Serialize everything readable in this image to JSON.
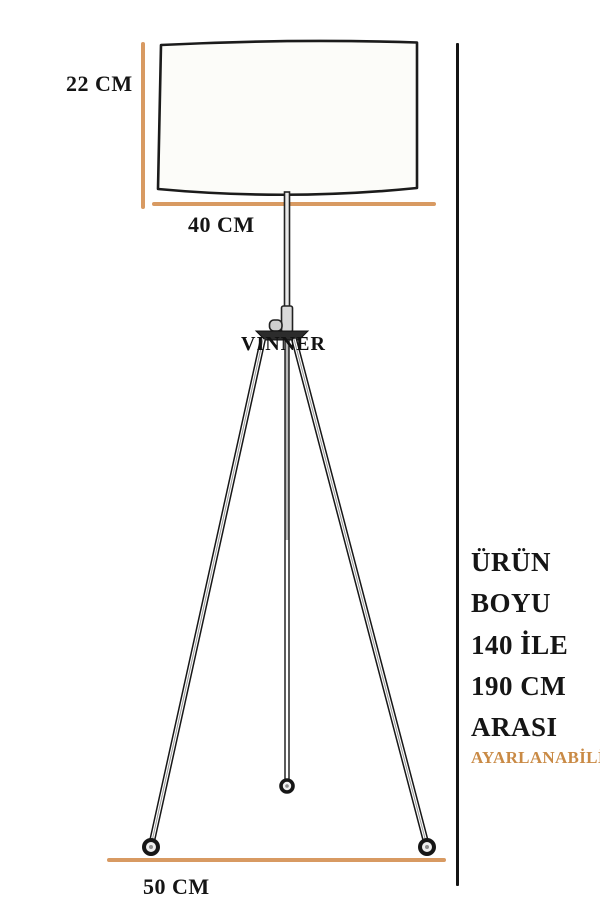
{
  "diagram": {
    "type": "product-dimension-diagram",
    "product": "tripod floor lamp",
    "labels": {
      "shade_height": "22 CM",
      "shade_width": "40 CM",
      "base_width": "50 CM"
    },
    "brand": "VINNER",
    "height_note": {
      "lines": [
        "ÜRÜN",
        "BOYU",
        "140 İLE",
        "190 CM",
        "ARASI"
      ],
      "full_text": "ÜRÜN BOYU 140 İLE 190 CM ARASI"
    },
    "adjustable_label": "AYARLANABİLİR"
  },
  "colors": {
    "dimension_line": "#d89a62",
    "adjustable_text": "#c98a45",
    "ink": "#151515",
    "shade_fill": "#fcfcf9"
  }
}
